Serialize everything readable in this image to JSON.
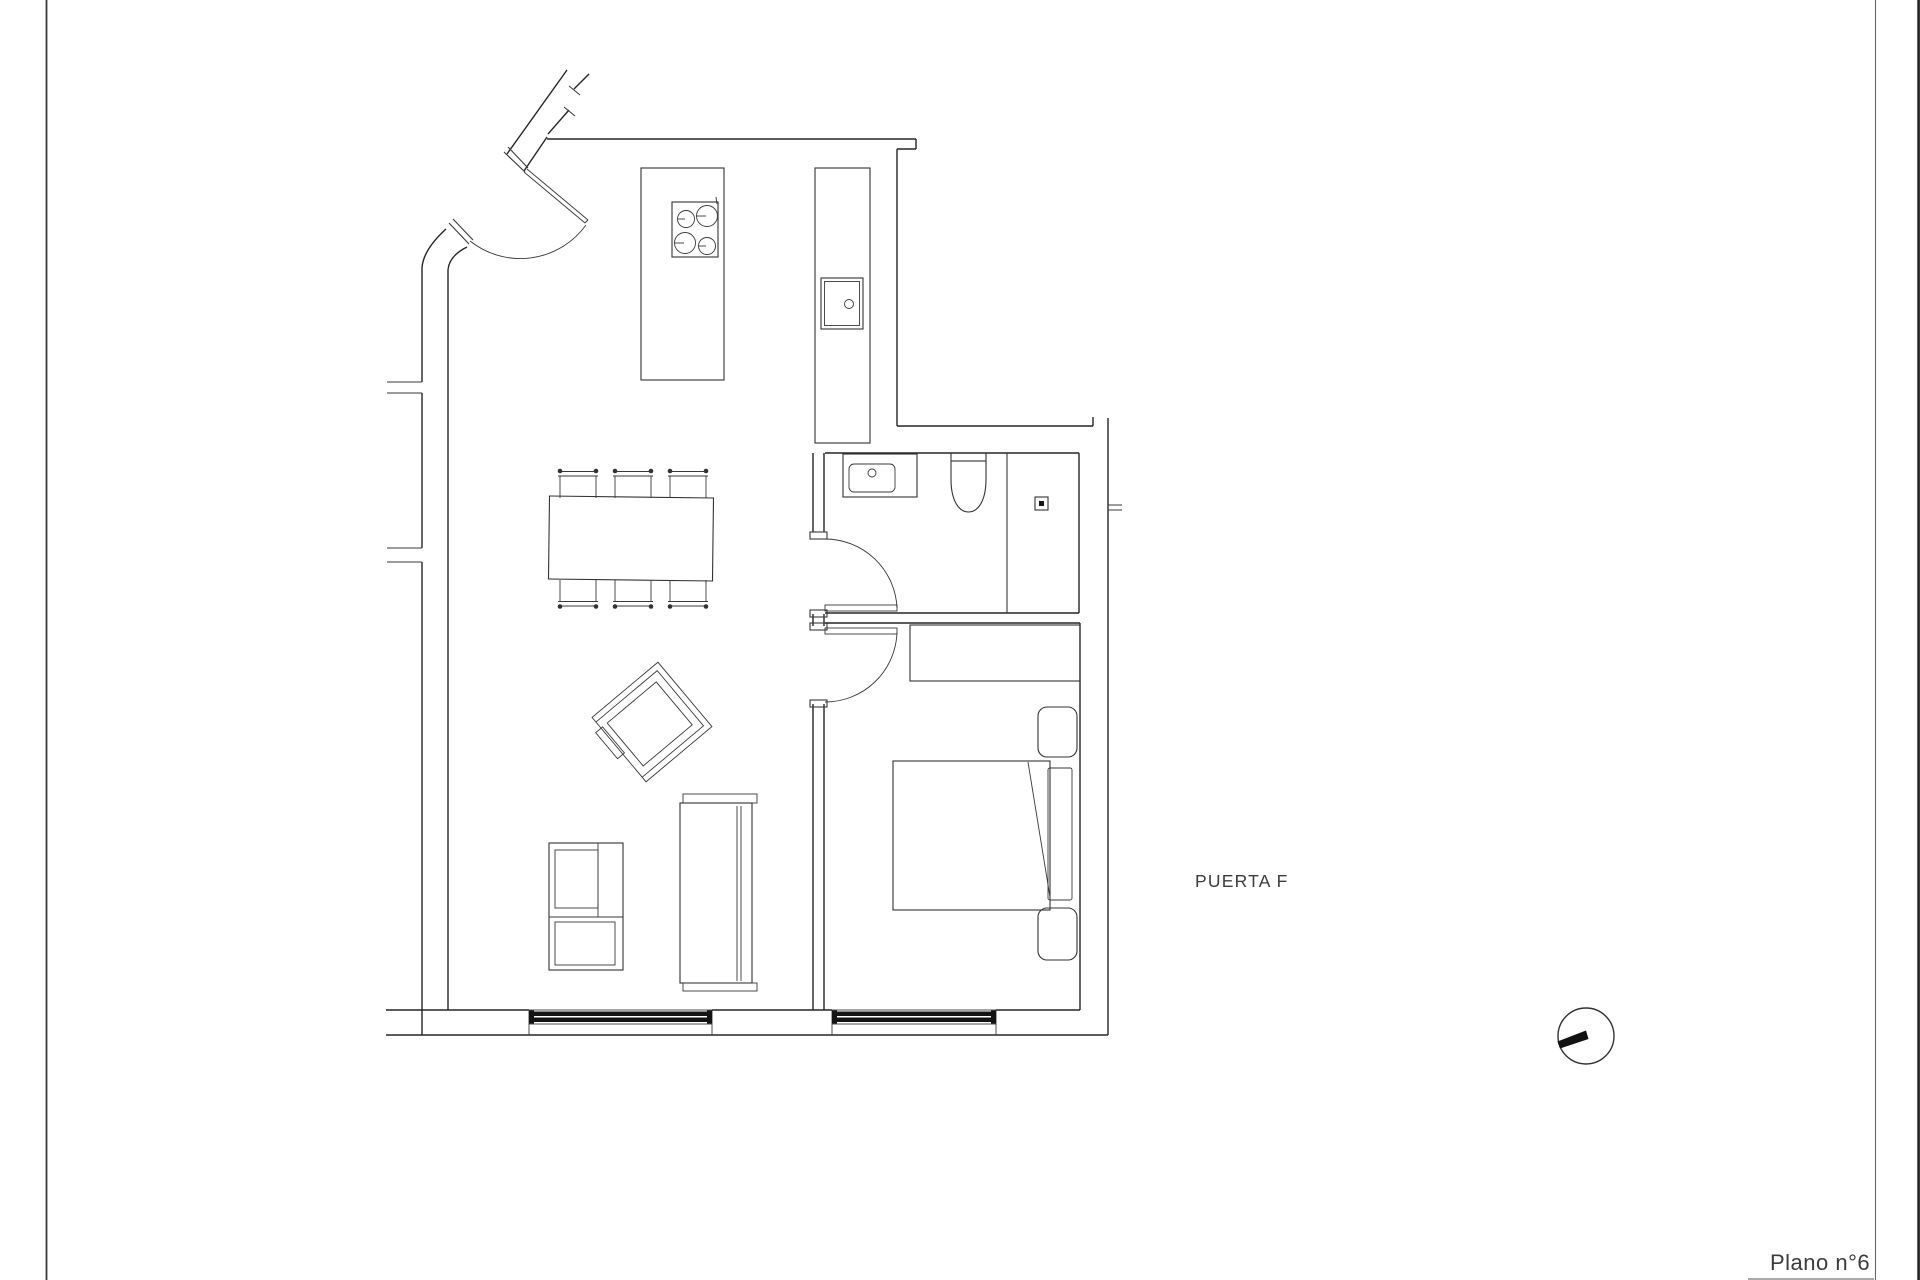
{
  "sheet": {
    "background": "#ffffff",
    "border_left_color": "#3a3a3a",
    "border_right_color": "#666666",
    "edge_color": "#222222",
    "line_color": "#262626",
    "window_glass_color": "#141414",
    "labels": {
      "door_label": "PUERTA F",
      "plan_number": "Plano n°6"
    },
    "symbols": {
      "orientation": "circle-with-hand-icon"
    }
  },
  "floor_plan": {
    "rooms": [
      "entry-hall",
      "kitchen-living-room",
      "bathroom",
      "bedroom"
    ],
    "fixtures": [
      "entrance-door-arc",
      "bathroom-door-arc",
      "bedroom-door-arc",
      "cooktop-4-burners",
      "kitchen-island",
      "counter-with-sink",
      "dining-table",
      "dining-chairs-x6",
      "armchair-rotated",
      "tv-console",
      "storage-cabinet",
      "vanity-sink",
      "toilet",
      "shower-with-drain",
      "wardrobe",
      "double-bed",
      "nightstand-top",
      "nightstand-bottom",
      "window-living",
      "window-bedroom"
    ]
  }
}
